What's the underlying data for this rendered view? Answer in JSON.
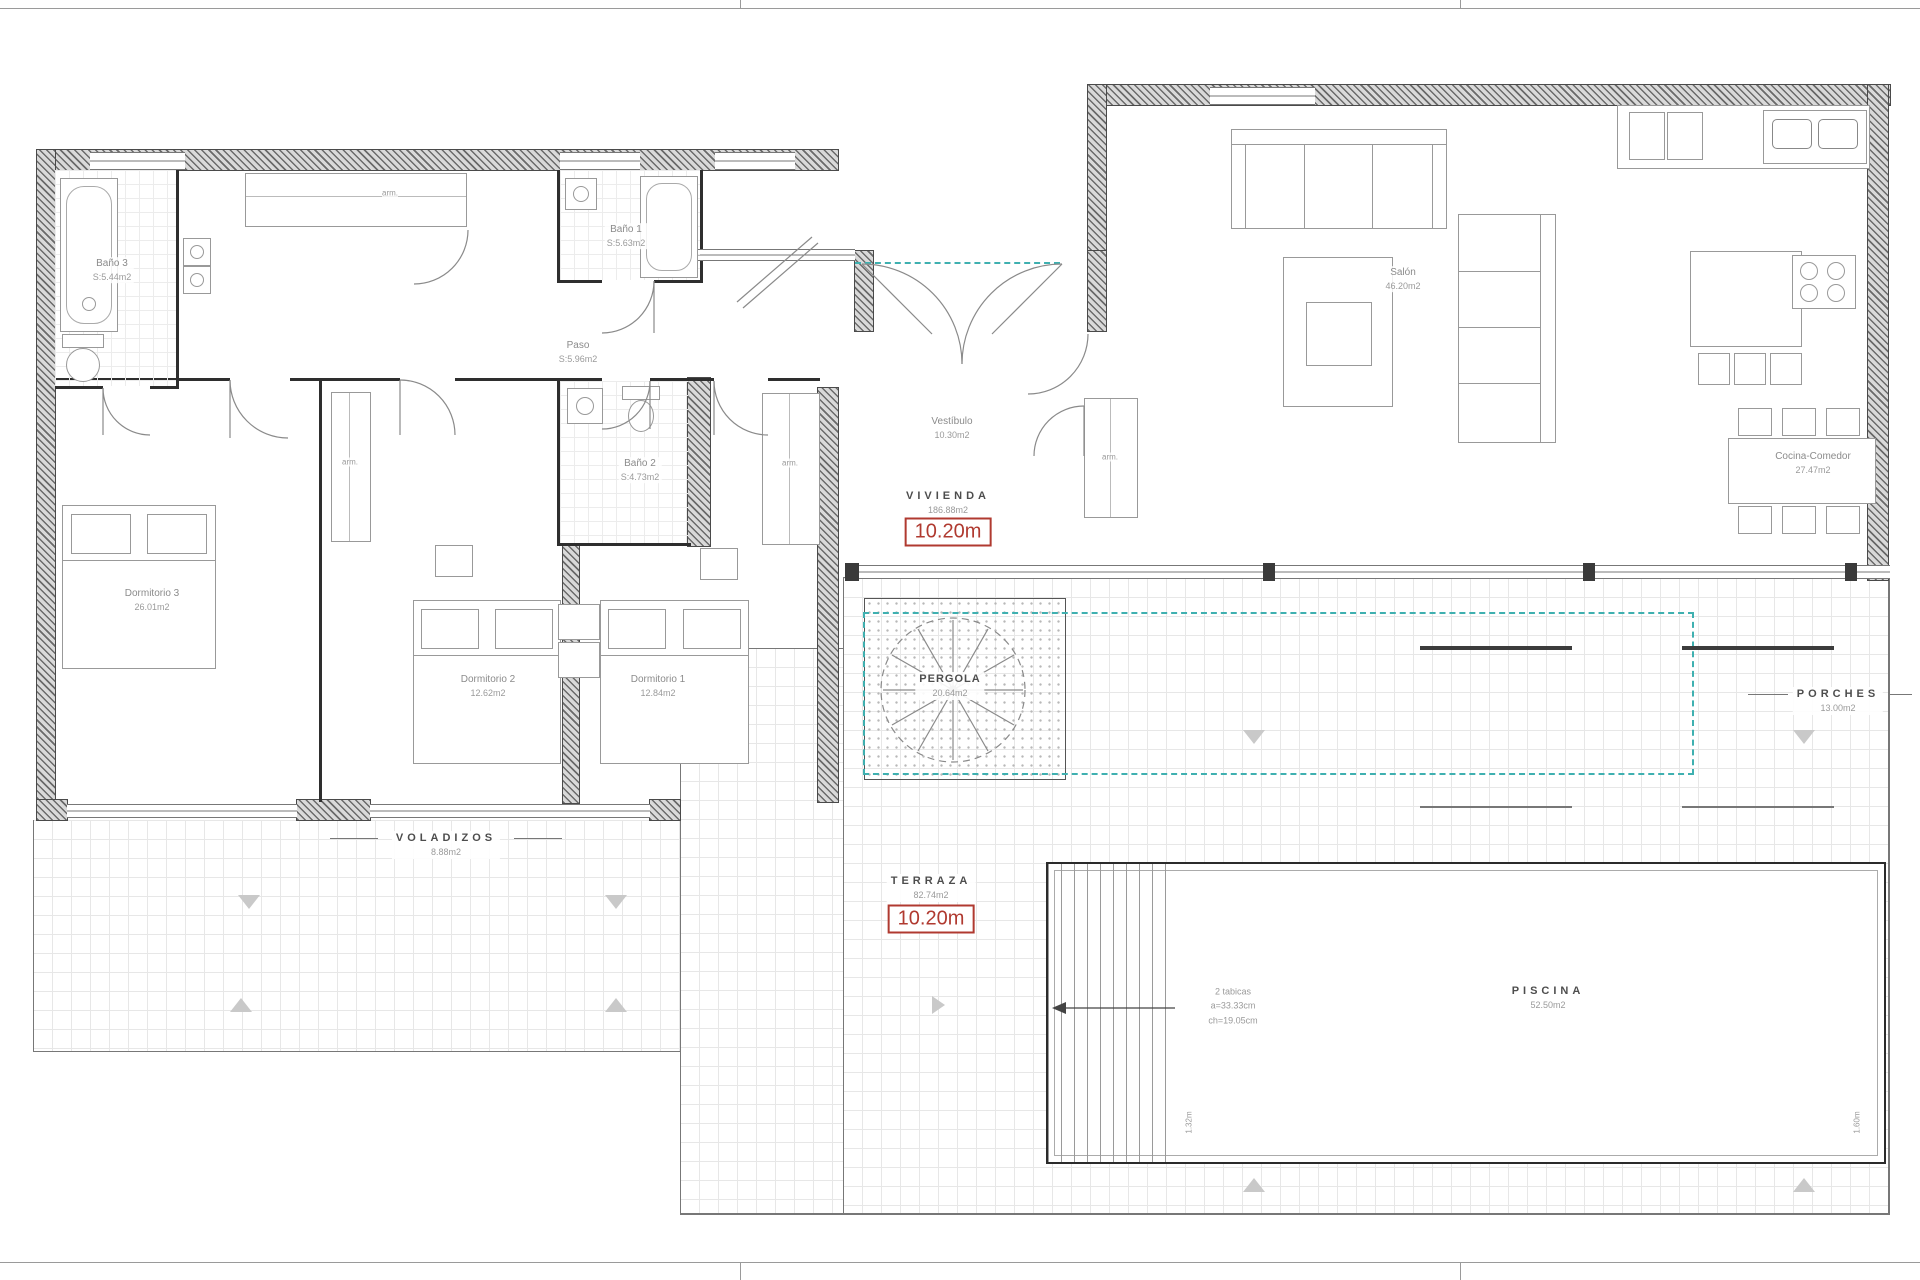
{
  "colors": {
    "accent_teal": "#3fb0b0",
    "accent_red": "#b03a30"
  },
  "rooms": {
    "bano3": {
      "name": "Baño 3",
      "area": "S:5.44m2"
    },
    "bano1": {
      "name": "Baño 1",
      "area": "S:5.63m2"
    },
    "paso": {
      "name": "Paso",
      "area": "S:5.96m2"
    },
    "bano2": {
      "name": "Baño 2",
      "area": "S:4.73m2"
    },
    "dormitorio3": {
      "name": "Dormitorio 3",
      "area": "26.01m2"
    },
    "dormitorio2": {
      "name": "Dormitorio 2",
      "area": "12.62m2"
    },
    "dormitorio1": {
      "name": "Dormitorio 1",
      "area": "12.84m2"
    },
    "vestibulo": {
      "name": "Vestíbulo",
      "area": "10.30m2"
    },
    "salon": {
      "name": "Salón",
      "area": "46.20m2"
    },
    "cocina": {
      "name": "Cocina-Comedor",
      "area": "27.47m2"
    }
  },
  "zones": {
    "vivienda": {
      "name": "VIVIENDA",
      "area": "186.88m2",
      "height": "10.20m"
    },
    "pergola": {
      "name": "PERGOLA",
      "area": "20.64m2"
    },
    "porches": {
      "name": "PORCHES",
      "area": "13.00m2"
    },
    "voladizos": {
      "name": "VOLADIZOS",
      "area": "8.88m2"
    },
    "terraza": {
      "name": "TERRAZA",
      "area": "82.74m2",
      "height": "10.20m"
    },
    "piscina": {
      "name": "PISCINA",
      "area": "52.50m2"
    }
  },
  "annotations": {
    "closet": "arm.",
    "pool_steps": {
      "line1": "2 tabicas",
      "line2": "a=33.33cm",
      "line3": "ch=19.05cm"
    },
    "pool_depth_left": "1.32m",
    "pool_depth_right": "1.60m"
  }
}
